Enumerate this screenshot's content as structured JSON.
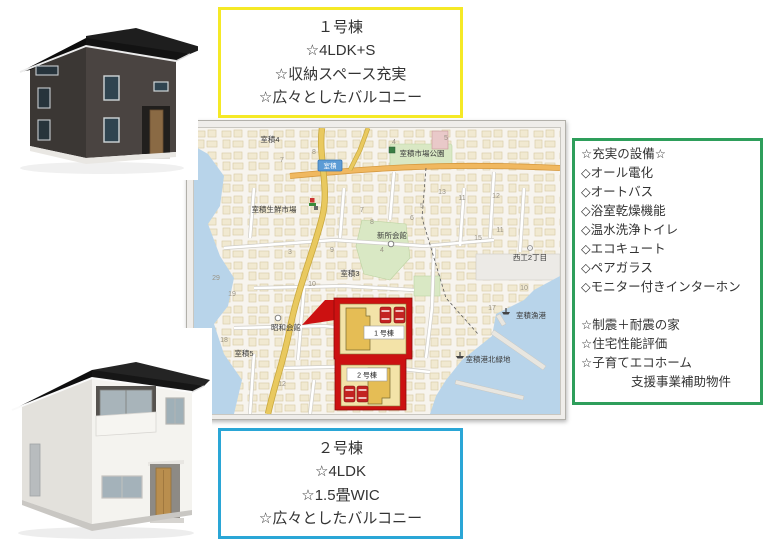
{
  "palette": {
    "callout1_border": "#f5e926",
    "callout2_border": "#2aa6d6",
    "features_border": "#2e9e5b",
    "site_outline": "#cc1111",
    "water": "#b8d4ea",
    "road_major": "#e9c95f",
    "road_orange": "#f0b860",
    "park_green": "#d9e8c4"
  },
  "callout_building1": {
    "lines": [
      "１号棟",
      "☆4LDK+S",
      "☆収納スペース充実",
      "☆広々としたバルコニー"
    ]
  },
  "callout_building2": {
    "lines": [
      "２号棟",
      "☆4LDK",
      "☆1.5畳WIC",
      "☆広々としたバルコニー"
    ]
  },
  "features": {
    "lines": [
      "☆充実の設備☆",
      "◇オール電化",
      "◇オートバス",
      "◇浴室乾燥機能",
      "◇温水洗浄トイレ",
      "◇エコキュート",
      "◇ペアガラス",
      "◇モニター付きインターホン",
      "",
      "☆制震＋耐震の家",
      "☆住宅性能評価",
      "☆子育てエコホーム",
      "　　　　支援事業補助物件"
    ]
  },
  "map": {
    "badge": {
      "text": "室積"
    },
    "labels": [
      {
        "text": "室積4",
        "x": 76,
        "y": 14
      },
      {
        "text": "室積市場公園",
        "x": 228,
        "y": 28
      },
      {
        "text": "室積生鮮市場",
        "x": 80,
        "y": 84
      },
      {
        "text": "新所会館",
        "x": 198,
        "y": 110
      },
      {
        "text": "室積3",
        "x": 156,
        "y": 148
      },
      {
        "text": "昭和会館",
        "x": 92,
        "y": 202
      },
      {
        "text": "室積5",
        "x": 50,
        "y": 228
      },
      {
        "text": "西工2丁目",
        "x": 336,
        "y": 132
      },
      {
        "text": "室積漁港",
        "x": 337,
        "y": 190
      },
      {
        "text": "室積港北緑地",
        "x": 294,
        "y": 234
      }
    ],
    "poi": [
      {
        "type": "park",
        "x": 198,
        "y": 22
      },
      {
        "type": "sign",
        "x": 118,
        "y": 72
      },
      {
        "type": "temple",
        "x": 122,
        "y": 80
      },
      {
        "type": "shrine",
        "x": 197,
        "y": 116
      },
      {
        "type": "shrine",
        "x": 84,
        "y": 190
      },
      {
        "type": "factory",
        "x": 336,
        "y": 120
      },
      {
        "type": "boat",
        "x": 312,
        "y": 183
      },
      {
        "type": "boat",
        "x": 266,
        "y": 227
      }
    ],
    "numbers": [
      {
        "t": "7",
        "x": 88,
        "y": 34
      },
      {
        "t": "8",
        "x": 120,
        "y": 26
      },
      {
        "t": "4",
        "x": 200,
        "y": 16
      },
      {
        "t": "5",
        "x": 252,
        "y": 12
      },
      {
        "t": "13",
        "x": 248,
        "y": 66
      },
      {
        "t": "11",
        "x": 268,
        "y": 72
      },
      {
        "t": "12",
        "x": 302,
        "y": 70
      },
      {
        "t": "6",
        "x": 218,
        "y": 92
      },
      {
        "t": "5",
        "x": 228,
        "y": 80
      },
      {
        "t": "8",
        "x": 178,
        "y": 96
      },
      {
        "t": "7",
        "x": 168,
        "y": 84
      },
      {
        "t": "3",
        "x": 96,
        "y": 126
      },
      {
        "t": "9",
        "x": 138,
        "y": 124
      },
      {
        "t": "10",
        "x": 118,
        "y": 158
      },
      {
        "t": "4",
        "x": 188,
        "y": 124
      },
      {
        "t": "15",
        "x": 284,
        "y": 112
      },
      {
        "t": "11",
        "x": 306,
        "y": 104
      },
      {
        "t": "17",
        "x": 298,
        "y": 182
      },
      {
        "t": "10",
        "x": 330,
        "y": 162
      },
      {
        "t": "29",
        "x": 22,
        "y": 152
      },
      {
        "t": "19",
        "x": 38,
        "y": 168
      },
      {
        "t": "18",
        "x": 30,
        "y": 214
      },
      {
        "t": "16",
        "x": 12,
        "y": 238
      },
      {
        "t": "8",
        "x": 142,
        "y": 246
      },
      {
        "t": "12",
        "x": 88,
        "y": 258
      },
      {
        "t": "14",
        "x": 10,
        "y": 280
      }
    ],
    "site": {
      "plot1_label": "1 号棟",
      "plot2_label": "2 号棟"
    }
  }
}
